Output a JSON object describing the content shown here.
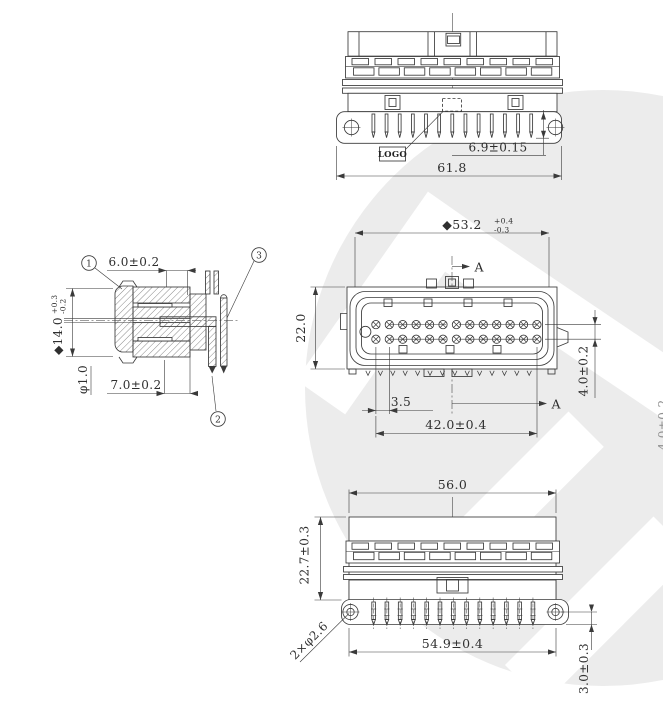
{
  "drawing": {
    "background_color": "#ffffff",
    "line_color": "#3a3a3a",
    "watermark_color": "#ececec",
    "section_label": "A",
    "balloons": {
      "b1": "1",
      "b2": "2",
      "b3": "3"
    },
    "views": {
      "rear_view": {
        "pin_count": 13,
        "logo_label": "LOGO",
        "dimensions": {
          "pin_protrusion": "6.9±0.15",
          "overall_width": "61.8"
        }
      },
      "side_section_view": {
        "dimensions": {
          "nose_length": "6.0±0.2",
          "seal_diameter": "◆14.0",
          "seal_tol_plus": "+0.3",
          "seal_tol_minus": "-0.2",
          "pin_diameter": "φ1.0",
          "body_length": "7.0±0.2"
        }
      },
      "front_view": {
        "pin_rows": 2,
        "pin_columns": 13,
        "dimensions": {
          "shroud_width": "◆53.2",
          "shroud_tol_plus": "+0.4",
          "shroud_tol_minus": "-0.3",
          "height": "22.0",
          "row_spacing": "4.0±0.2",
          "pin_pitch": "3.5",
          "pin_span": "42.0±0.4"
        }
      },
      "bottom_view": {
        "pin_count": 13,
        "dimensions": {
          "overall_width": "56.0",
          "body_height": "22.7±0.3",
          "mounting_holes": "2×φ2.6",
          "hole_span": "54.9±0.4",
          "pin_standoff": "3.0±0.3"
        }
      }
    },
    "clipped_dimension": "4.0±0.2"
  }
}
